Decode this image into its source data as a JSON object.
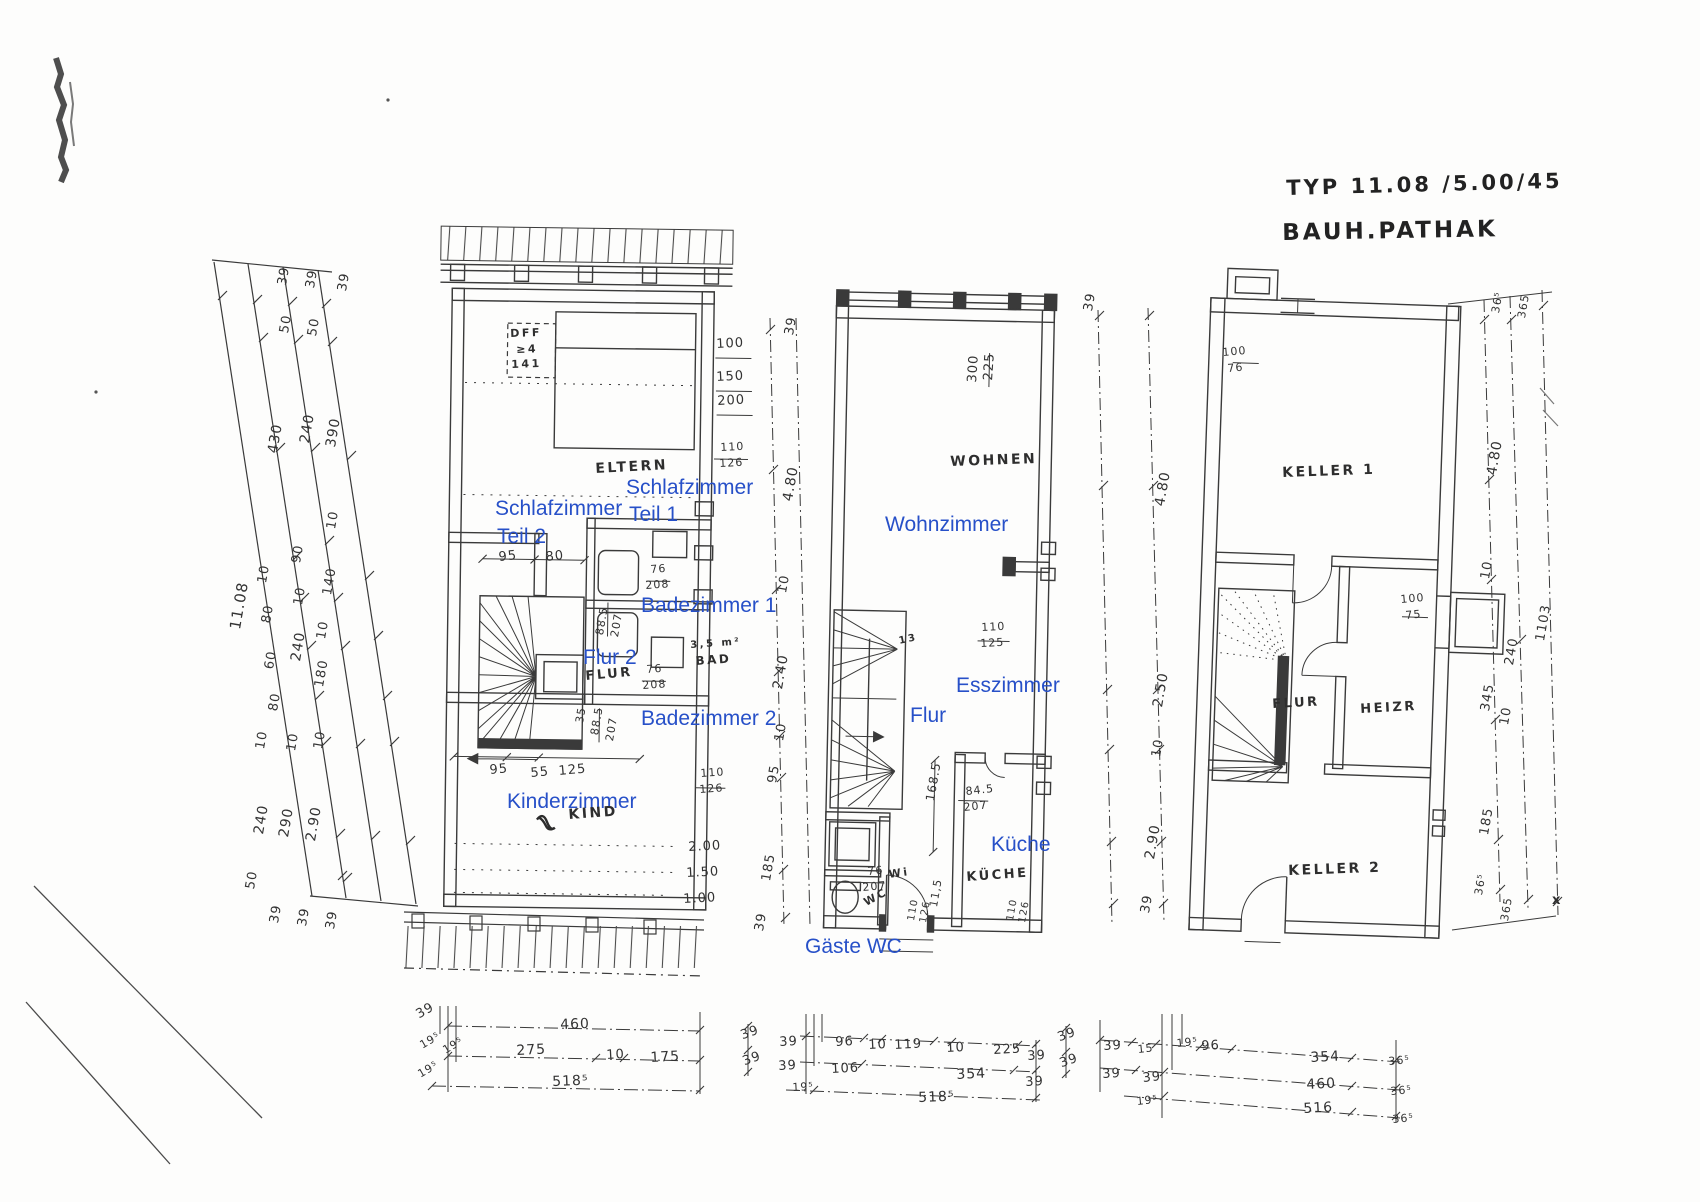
{
  "document": {
    "title_line1": "TYP 11.08 /5.00/45",
    "title_line2": "BAUH.PATHAK"
  },
  "colors": {
    "annotation_blue": "#2750c8",
    "ink": "#3a3a3a",
    "paper": "#fdfdfc"
  },
  "plans": [
    {
      "position": "left",
      "level": "upper floor",
      "rooms": [
        "Schlafzimmer Teil 1",
        "Schlafzimmer Teil 2",
        "Badezimmer 1",
        "Badezimmer 2",
        "Flur 2",
        "Kinderzimmer"
      ]
    },
    {
      "position": "middle",
      "level": "ground floor",
      "rooms": [
        "Wohnzimmer",
        "Esszimmer",
        "Flur",
        "Küche",
        "Gäste WC"
      ]
    },
    {
      "position": "right",
      "level": "basement",
      "rooms": [
        "Keller 1",
        "Flur",
        "Heizr",
        "Keller 2"
      ]
    }
  ],
  "annotations": {
    "blue": [
      {
        "t": "Schlafzimmer",
        "x": 626,
        "y": 477
      },
      {
        "t": "Teil 1",
        "x": 629,
        "y": 504
      },
      {
        "t": "Schlafzimmer",
        "x": 495,
        "y": 498
      },
      {
        "t": "Teil 2",
        "x": 497,
        "y": 526
      },
      {
        "t": "Badezimmer 1",
        "x": 641,
        "y": 595
      },
      {
        "t": "Flur 2",
        "x": 583,
        "y": 647
      },
      {
        "t": "Badezimmer 2",
        "x": 641,
        "y": 708
      },
      {
        "t": "Kinderzimmer",
        "x": 507,
        "y": 791
      },
      {
        "t": "Wohnzimmer",
        "x": 885,
        "y": 514
      },
      {
        "t": "Esszimmer",
        "x": 956,
        "y": 675
      },
      {
        "t": "Flur",
        "x": 910,
        "y": 705
      },
      {
        "t": "Küche",
        "x": 991,
        "y": 834
      },
      {
        "t": "Gäste WC",
        "x": 805,
        "y": 936
      }
    ],
    "hand": [
      {
        "t": "ELTERN",
        "x": 595,
        "y": 462,
        "r": -3
      },
      {
        "t": "DFF",
        "x": 510,
        "y": 328,
        "r": -2,
        "s": 11
      },
      {
        "t": "≥4",
        "x": 516,
        "y": 344,
        "r": -2,
        "s": 11
      },
      {
        "t": "141",
        "x": 511,
        "y": 359,
        "r": -2,
        "s": 11
      },
      {
        "t": "FLUR",
        "x": 585,
        "y": 670,
        "r": -5,
        "s": 13
      },
      {
        "t": "3,5 m²",
        "x": 690,
        "y": 641,
        "r": -4,
        "s": 10
      },
      {
        "t": "BAD",
        "x": 695,
        "y": 655,
        "r": -4,
        "s": 12
      },
      {
        "t": "KIND",
        "x": 568,
        "y": 808,
        "r": -4
      },
      {
        "t": "WOHNEN",
        "x": 950,
        "y": 455,
        "r": -2
      },
      {
        "t": "KÜCHE",
        "x": 966,
        "y": 871,
        "r": -4,
        "s": 13
      },
      {
        "t": "WC",
        "x": 862,
        "y": 898,
        "r": -28,
        "s": 11
      },
      {
        "t": "Wi",
        "x": 888,
        "y": 869,
        "r": -8,
        "s": 11
      },
      {
        "t": "13",
        "x": 898,
        "y": 637,
        "r": -12,
        "s": 10
      },
      {
        "t": "KELLER 1",
        "x": 1282,
        "y": 466,
        "r": -2
      },
      {
        "t": "FLUR",
        "x": 1272,
        "y": 698,
        "r": -3,
        "s": 13
      },
      {
        "t": "HEIZR",
        "x": 1360,
        "y": 703,
        "r": -3,
        "s": 13
      },
      {
        "t": "KELLER 2",
        "x": 1288,
        "y": 864,
        "r": -2
      },
      {
        "t": "x",
        "x": 1552,
        "y": 894,
        "r": 0,
        "s": 13
      }
    ],
    "dims": [
      {
        "t": "39",
        "x": 276,
        "y": 284,
        "r": -80
      },
      {
        "t": "39",
        "x": 304,
        "y": 287,
        "r": -80
      },
      {
        "t": "39",
        "x": 336,
        "y": 290,
        "r": -80
      },
      {
        "t": "50",
        "x": 278,
        "y": 332,
        "r": -80
      },
      {
        "t": "50",
        "x": 306,
        "y": 335,
        "r": -80
      },
      {
        "t": "430",
        "x": 266,
        "y": 452,
        "r": -80,
        "s": 14
      },
      {
        "t": "240",
        "x": 298,
        "y": 442,
        "r": -80,
        "s": 14
      },
      {
        "t": "390",
        "x": 324,
        "y": 446,
        "r": -80,
        "s": 14
      },
      {
        "t": "10",
        "x": 325,
        "y": 528,
        "r": -80
      },
      {
        "t": "11.08",
        "x": 228,
        "y": 628,
        "r": -80,
        "s": 15
      },
      {
        "t": "10",
        "x": 256,
        "y": 582,
        "r": -80
      },
      {
        "t": "80",
        "x": 260,
        "y": 622,
        "r": -80
      },
      {
        "t": "60",
        "x": 263,
        "y": 668,
        "r": -80
      },
      {
        "t": "80",
        "x": 267,
        "y": 710,
        "r": -80
      },
      {
        "t": "10",
        "x": 254,
        "y": 748,
        "r": -80
      },
      {
        "t": "240",
        "x": 252,
        "y": 833,
        "r": -80,
        "s": 14
      },
      {
        "t": "50",
        "x": 244,
        "y": 888,
        "r": -80
      },
      {
        "t": "90",
        "x": 290,
        "y": 562,
        "r": -80
      },
      {
        "t": "10",
        "x": 292,
        "y": 604,
        "r": -80
      },
      {
        "t": "240",
        "x": 289,
        "y": 660,
        "r": -80,
        "s": 14
      },
      {
        "t": "10",
        "x": 285,
        "y": 750,
        "r": -80
      },
      {
        "t": "290",
        "x": 277,
        "y": 836,
        "r": -80,
        "s": 14
      },
      {
        "t": "140",
        "x": 321,
        "y": 594,
        "r": -80,
        "s": 13
      },
      {
        "t": "10",
        "x": 315,
        "y": 638,
        "r": -80
      },
      {
        "t": "180",
        "x": 313,
        "y": 686,
        "r": -80,
        "s": 13
      },
      {
        "t": "10",
        "x": 312,
        "y": 748,
        "r": -80
      },
      {
        "t": "2.90",
        "x": 304,
        "y": 840,
        "r": -80,
        "s": 14
      },
      {
        "t": "39",
        "x": 268,
        "y": 922,
        "r": -80
      },
      {
        "t": "39",
        "x": 296,
        "y": 925,
        "r": -80
      },
      {
        "t": "39",
        "x": 324,
        "y": 928,
        "r": -80
      },
      {
        "t": "100",
        "x": 716,
        "y": 338,
        "r": -3
      },
      {
        "t": "150",
        "x": 716,
        "y": 371,
        "r": -3
      },
      {
        "t": "200",
        "x": 717,
        "y": 395,
        "r": -3
      },
      {
        "t": "110",
        "x": 720,
        "y": 442,
        "r": -3,
        "s": 11
      },
      {
        "t": "126",
        "x": 719,
        "y": 458,
        "r": -3,
        "s": 11
      },
      {
        "t": "95",
        "x": 498,
        "y": 551,
        "r": -6
      },
      {
        "t": "80",
        "x": 545,
        "y": 551,
        "r": -6
      },
      {
        "t": "76",
        "x": 650,
        "y": 564,
        "r": -4,
        "s": 11
      },
      {
        "t": "208",
        "x": 645,
        "y": 580,
        "r": -4,
        "s": 11
      },
      {
        "t": "88.5",
        "x": 594,
        "y": 634,
        "r": -80,
        "s": 11
      },
      {
        "t": "207",
        "x": 609,
        "y": 636,
        "r": -80,
        "s": 11
      },
      {
        "t": "76",
        "x": 646,
        "y": 664,
        "r": -4,
        "s": 11
      },
      {
        "t": "208",
        "x": 642,
        "y": 680,
        "r": -4,
        "s": 11
      },
      {
        "t": "35",
        "x": 574,
        "y": 722,
        "r": -80,
        "s": 11
      },
      {
        "t": "88.5",
        "x": 589,
        "y": 734,
        "r": -80,
        "s": 11
      },
      {
        "t": "207",
        "x": 604,
        "y": 740,
        "r": -80,
        "s": 11
      },
      {
        "t": "95",
        "x": 489,
        "y": 764,
        "r": -5
      },
      {
        "t": "55",
        "x": 530,
        "y": 767,
        "r": -5
      },
      {
        "t": "125",
        "x": 558,
        "y": 765,
        "r": -5
      },
      {
        "t": "110",
        "x": 700,
        "y": 768,
        "r": -4,
        "s": 11
      },
      {
        "t": "126",
        "x": 699,
        "y": 784,
        "r": -4,
        "s": 11
      },
      {
        "t": "2.00",
        "x": 688,
        "y": 841,
        "r": -3
      },
      {
        "t": "1.50",
        "x": 686,
        "y": 867,
        "r": -3
      },
      {
        "t": "1.00",
        "x": 683,
        "y": 893,
        "r": -3
      },
      {
        "t": "460",
        "x": 560,
        "y": 1018,
        "r": -2,
        "s": 14
      },
      {
        "t": "275",
        "x": 516,
        "y": 1044,
        "r": -3,
        "s": 14
      },
      {
        "t": "10",
        "x": 606,
        "y": 1049,
        "r": -3
      },
      {
        "t": "175",
        "x": 650,
        "y": 1051,
        "r": -3,
        "s": 14
      },
      {
        "t": "518⁵",
        "x": 552,
        "y": 1075,
        "r": -2,
        "s": 14
      },
      {
        "t": "39",
        "x": 414,
        "y": 1010,
        "r": -30
      },
      {
        "t": "19⁵",
        "x": 418,
        "y": 1041,
        "r": -30,
        "s": 11
      },
      {
        "t": "19⁵",
        "x": 441,
        "y": 1046,
        "r": -30,
        "s": 11
      },
      {
        "t": "19⁵",
        "x": 416,
        "y": 1070,
        "r": -30,
        "s": 11
      },
      {
        "t": "39",
        "x": 783,
        "y": 334,
        "r": -80
      },
      {
        "t": "4.80",
        "x": 781,
        "y": 500,
        "r": -80,
        "s": 14
      },
      {
        "t": "10",
        "x": 776,
        "y": 592,
        "r": -80
      },
      {
        "t": "2.40",
        "x": 771,
        "y": 688,
        "r": -80,
        "s": 14
      },
      {
        "t": "10",
        "x": 773,
        "y": 740,
        "r": -80
      },
      {
        "t": "95",
        "x": 766,
        "y": 782,
        "r": -80
      },
      {
        "t": "185",
        "x": 760,
        "y": 880,
        "r": -80,
        "s": 13
      },
      {
        "t": "39",
        "x": 753,
        "y": 930,
        "r": -80
      },
      {
        "t": "300",
        "x": 966,
        "y": 382,
        "r": -86
      },
      {
        "t": "225",
        "x": 982,
        "y": 380,
        "r": -86
      },
      {
        "t": "110",
        "x": 981,
        "y": 622,
        "r": -3,
        "s": 11
      },
      {
        "t": "125",
        "x": 980,
        "y": 638,
        "r": -3,
        "s": 11
      },
      {
        "t": "168.5",
        "x": 924,
        "y": 800,
        "r": -80,
        "s": 12
      },
      {
        "t": "84.5",
        "x": 965,
        "y": 786,
        "r": -6,
        "s": 11
      },
      {
        "t": "207",
        "x": 963,
        "y": 802,
        "r": -6,
        "s": 11
      },
      {
        "t": "76",
        "x": 867,
        "y": 866,
        "r": -5,
        "s": 11
      },
      {
        "t": "207",
        "x": 862,
        "y": 882,
        "r": -5,
        "s": 11
      },
      {
        "t": "110",
        "x": 907,
        "y": 920,
        "r": -80,
        "s": 10
      },
      {
        "t": "126",
        "x": 919,
        "y": 922,
        "r": -80,
        "s": 10
      },
      {
        "t": "11,5",
        "x": 928,
        "y": 906,
        "r": -80,
        "s": 11
      },
      {
        "t": "110",
        "x": 1006,
        "y": 920,
        "r": -80,
        "s": 10
      },
      {
        "t": "126",
        "x": 1018,
        "y": 922,
        "r": -80,
        "s": 10
      },
      {
        "t": "39",
        "x": 1082,
        "y": 310,
        "r": -80
      },
      {
        "t": "4.80",
        "x": 1153,
        "y": 505,
        "r": -80,
        "s": 14
      },
      {
        "t": "2.50",
        "x": 1151,
        "y": 706,
        "r": -80,
        "s": 14
      },
      {
        "t": "10",
        "x": 1150,
        "y": 756,
        "r": -80
      },
      {
        "t": "2.90",
        "x": 1143,
        "y": 858,
        "r": -80,
        "s": 14
      },
      {
        "t": "39",
        "x": 1139,
        "y": 912,
        "r": -80
      },
      {
        "t": "39",
        "x": 739,
        "y": 1030,
        "r": -20
      },
      {
        "t": "39",
        "x": 741,
        "y": 1056,
        "r": -20
      },
      {
        "t": "39",
        "x": 779,
        "y": 1036,
        "r": -3
      },
      {
        "t": "96",
        "x": 835,
        "y": 1036,
        "r": -3
      },
      {
        "t": "10",
        "x": 868,
        "y": 1039,
        "r": -3
      },
      {
        "t": "119",
        "x": 894,
        "y": 1039,
        "r": -3
      },
      {
        "t": "10",
        "x": 946,
        "y": 1042,
        "r": -3
      },
      {
        "t": "225",
        "x": 993,
        "y": 1044,
        "r": -3
      },
      {
        "t": "39",
        "x": 1027,
        "y": 1050,
        "r": -3
      },
      {
        "t": "39",
        "x": 778,
        "y": 1060,
        "r": -3
      },
      {
        "t": "106",
        "x": 831,
        "y": 1063,
        "r": -3
      },
      {
        "t": "354",
        "x": 956,
        "y": 1068,
        "r": -3,
        "s": 14
      },
      {
        "t": "39",
        "x": 1025,
        "y": 1076,
        "r": -3
      },
      {
        "t": "19⁵",
        "x": 792,
        "y": 1082,
        "r": -3,
        "s": 11
      },
      {
        "t": "518⁵",
        "x": 918,
        "y": 1091,
        "r": -2,
        "s": 14
      },
      {
        "t": "100",
        "x": 1222,
        "y": 347,
        "r": -5,
        "s": 11
      },
      {
        "t": "76",
        "x": 1227,
        "y": 363,
        "r": -5,
        "s": 11
      },
      {
        "t": "100",
        "x": 1400,
        "y": 594,
        "r": -5,
        "s": 11
      },
      {
        "t": "75",
        "x": 1405,
        "y": 610,
        "r": -5,
        "s": 11
      },
      {
        "t": "36⁵",
        "x": 1490,
        "y": 312,
        "r": -80,
        "s": 11
      },
      {
        "t": "365",
        "x": 1516,
        "y": 317,
        "r": -80,
        "s": 11
      },
      {
        "t": "4.80",
        "x": 1485,
        "y": 474,
        "r": -80,
        "s": 14
      },
      {
        "t": "10",
        "x": 1479,
        "y": 578,
        "r": -80
      },
      {
        "t": "1103",
        "x": 1534,
        "y": 640,
        "r": -80,
        "s": 13
      },
      {
        "t": "240",
        "x": 1503,
        "y": 664,
        "r": -80,
        "s": 13
      },
      {
        "t": "345",
        "x": 1479,
        "y": 710,
        "r": -80,
        "s": 13
      },
      {
        "t": "10",
        "x": 1498,
        "y": 724,
        "r": -80
      },
      {
        "t": "185",
        "x": 1478,
        "y": 834,
        "r": -80,
        "s": 13
      },
      {
        "t": "36⁵",
        "x": 1473,
        "y": 894,
        "r": -80,
        "s": 11
      },
      {
        "t": "365",
        "x": 1499,
        "y": 920,
        "r": -80,
        "s": 11
      },
      {
        "t": "39",
        "x": 1103,
        "y": 1040,
        "r": -3
      },
      {
        "t": "15",
        "x": 1137,
        "y": 1044,
        "r": -6,
        "s": 11
      },
      {
        "t": "19⁵",
        "x": 1176,
        "y": 1038,
        "r": -6,
        "s": 11
      },
      {
        "t": "96",
        "x": 1201,
        "y": 1040,
        "r": -3
      },
      {
        "t": "354",
        "x": 1310,
        "y": 1051,
        "r": -3,
        "s": 14
      },
      {
        "t": "36⁵",
        "x": 1388,
        "y": 1056,
        "r": -5,
        "s": 11
      },
      {
        "t": "39",
        "x": 1102,
        "y": 1068,
        "r": -3
      },
      {
        "t": "39",
        "x": 1142,
        "y": 1072,
        "r": -6
      },
      {
        "t": "460",
        "x": 1306,
        "y": 1078,
        "r": -3,
        "s": 14
      },
      {
        "t": "36⁵",
        "x": 1390,
        "y": 1086,
        "r": -5,
        "s": 11
      },
      {
        "t": "19⁵",
        "x": 1136,
        "y": 1096,
        "r": -6,
        "s": 11
      },
      {
        "t": "516",
        "x": 1303,
        "y": 1102,
        "r": -3,
        "s": 14
      },
      {
        "t": "36⁵",
        "x": 1392,
        "y": 1114,
        "r": -5,
        "s": 11
      },
      {
        "t": "39",
        "x": 1056,
        "y": 1032,
        "r": -20
      },
      {
        "t": "39",
        "x": 1058,
        "y": 1058,
        "r": -20
      }
    ]
  }
}
